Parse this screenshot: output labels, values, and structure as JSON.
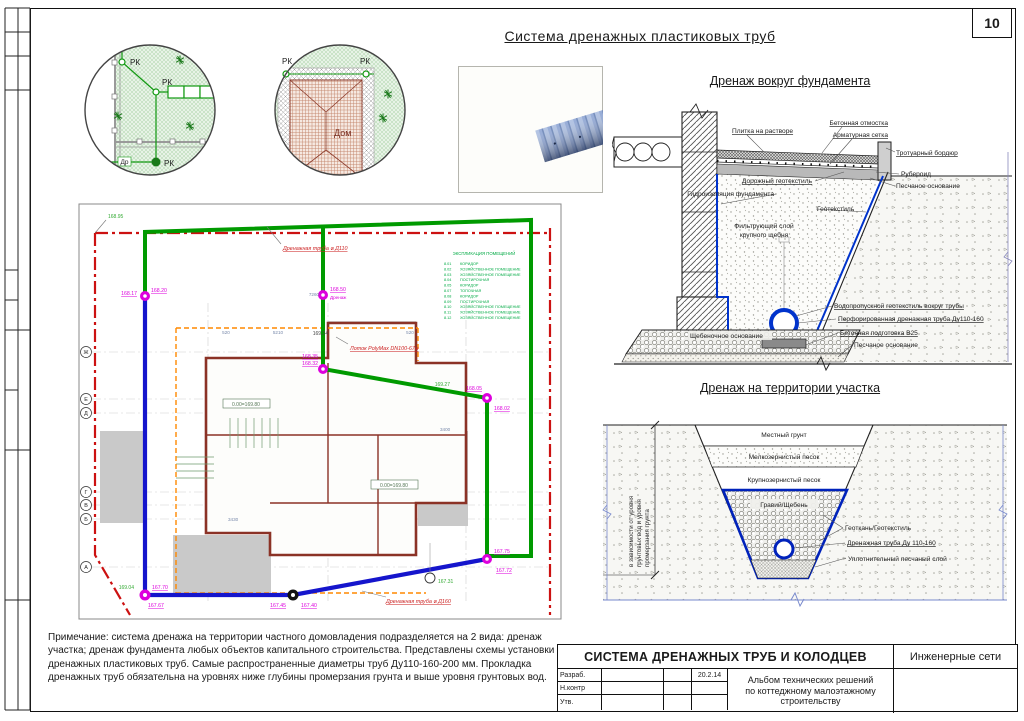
{
  "page": {
    "number": "10",
    "title": "Система дренажных пластиковых труб"
  },
  "details": {
    "c1": {
      "rk1": "РК",
      "rk2": "РК",
      "rk3": "РК",
      "dr": "Др"
    },
    "c2": {
      "rk1": "РК",
      "rk2": "РК",
      "house": "Дом"
    }
  },
  "sections": {
    "foundation": {
      "title": "Дренаж вокруг фундамента",
      "labels": {
        "tile": "Плитка на растворе",
        "otmostka": "Бетонная отмостка",
        "setka": "Арматурная сетка",
        "bordur": "Тротуарный бордюр",
        "ruberoid": "Рубероид",
        "sand_top": "Песчаное основание",
        "road_geo": "Дорожный геотекстиль",
        "waterproof": "Гидроизоляция фундамента",
        "geotextile": "Геотекстиль",
        "filter1": "Фильтрующий слой",
        "filter2": "крупного щебня",
        "vodoprop": "Водопропускной геотекстиль вокруг трубы",
        "perf": "Перфорированная дренажная труба Ду110-160",
        "shcheben": "Щебеночное основание",
        "beton": "Бетонная подготовка В25",
        "sand_bottom": "Песчаное основание"
      }
    },
    "territory": {
      "title": "Дренаж на территории участка",
      "labels": {
        "local": "Местный грунт",
        "fine_sand": "Мелкозернистый песок",
        "coarse_sand": "Крупнозернистый песок",
        "gravel": "Гравий/Щебень",
        "geo": "Геоткань/Геотекстиль",
        "pipe": "Дренажная труба Ду 110-160",
        "seal_sand": "Уплотнительный песчаный слой",
        "depth1": "в зависимости от уровня",
        "depth2": "грунтовых вод и уровня",
        "depth3": "промерзания грунта"
      }
    }
  },
  "plan": {
    "pipe110": "Дренажная труба ⌀ Д110",
    "pipe160": "Дренажная труба ⌀ Д160",
    "lotok": "Лоток PolyMax DN100-67м",
    "drenazh": "Дренаж",
    "level": "0.00=169.80",
    "axes": [
      "Ж",
      "Е",
      "Д",
      "Г",
      "В",
      "Б",
      "А"
    ],
    "nodes": [
      {
        "v1": "168.20",
        "v2": "168.17"
      },
      {
        "v1": "168.50"
      },
      {
        "v1": "168.35",
        "v2": "168.32"
      },
      {
        "v1": "168.05",
        "v2": "168.02"
      },
      {
        "v1": "167.75",
        "v2": "167.72"
      },
      {
        "v1": "167.70",
        "v2": "167.67"
      },
      {
        "v1": "167.45",
        "v2": "167.40"
      }
    ],
    "marks": [
      "168.95",
      "169.04",
      "169.27",
      "169.24",
      "167.31"
    ],
    "dims": [
      "7260",
      "520",
      "5210",
      "520",
      "3400",
      "3430"
    ],
    "explication": {
      "title": "ЭКСПЛИКАЦИЯ ПОМЕЩЕНИЙ",
      "rows": [
        {
          "n": "8.01",
          "name": "КОРИДОР"
        },
        {
          "n": "8.02",
          "name": "ХОЗЯЙСТВЕННОЕ ПОМЕЩЕНИЕ"
        },
        {
          "n": "8.03",
          "name": "ХОЗЯЙСТВЕННОЕ ПОМЕЩЕНИЕ"
        },
        {
          "n": "8.04",
          "name": "ПОСТИРОЧНАЯ"
        },
        {
          "n": "8.05",
          "name": "КОРИДОР"
        },
        {
          "n": "8.07",
          "name": "ТОПОЧНАЯ"
        },
        {
          "n": "8.08",
          "name": "КОРИДОР"
        },
        {
          "n": "8.09",
          "name": "ПОСТИРОЧНАЯ"
        },
        {
          "n": "8.10",
          "name": "ХОЗЯЙСТВЕННОЕ ПОМЕЩЕНИЕ"
        },
        {
          "n": "8.11",
          "name": "ХОЗЯЙСТВЕННОЕ ПОМЕЩЕНИЕ"
        },
        {
          "n": "8.12",
          "name": "ХОЗЯЙСТВЕННОЕ ПОМЕЩЕНИЕ"
        }
      ]
    }
  },
  "note": {
    "text": "Примечание: система дренажа на территории частного домовладения подразделяется на 2 вида: дренаж участка; дренаж фундамента любых объектов капитального строительства. Представлены схемы установки дренажных пластиковых труб. Самые распространенные диаметры труб Ду110-160-200 мм. Прокладка дренажных труб обязательна на уровнях ниже глубины промерзания грунта и выше уровня грунтовых вод."
  },
  "title_block": {
    "doc_title": "СИСТЕМА ДРЕНАЖНЫХ ТРУБ И КОЛОДЦЕВ",
    "category": "Инженерные сети",
    "album1": "Альбом технических решений",
    "album2": "по коттеджному малоэтажному",
    "album3": "строительству",
    "date": "20.2.14",
    "row1": "Разраб.",
    "row2": "Н.контр",
    "row3": "Утв."
  }
}
